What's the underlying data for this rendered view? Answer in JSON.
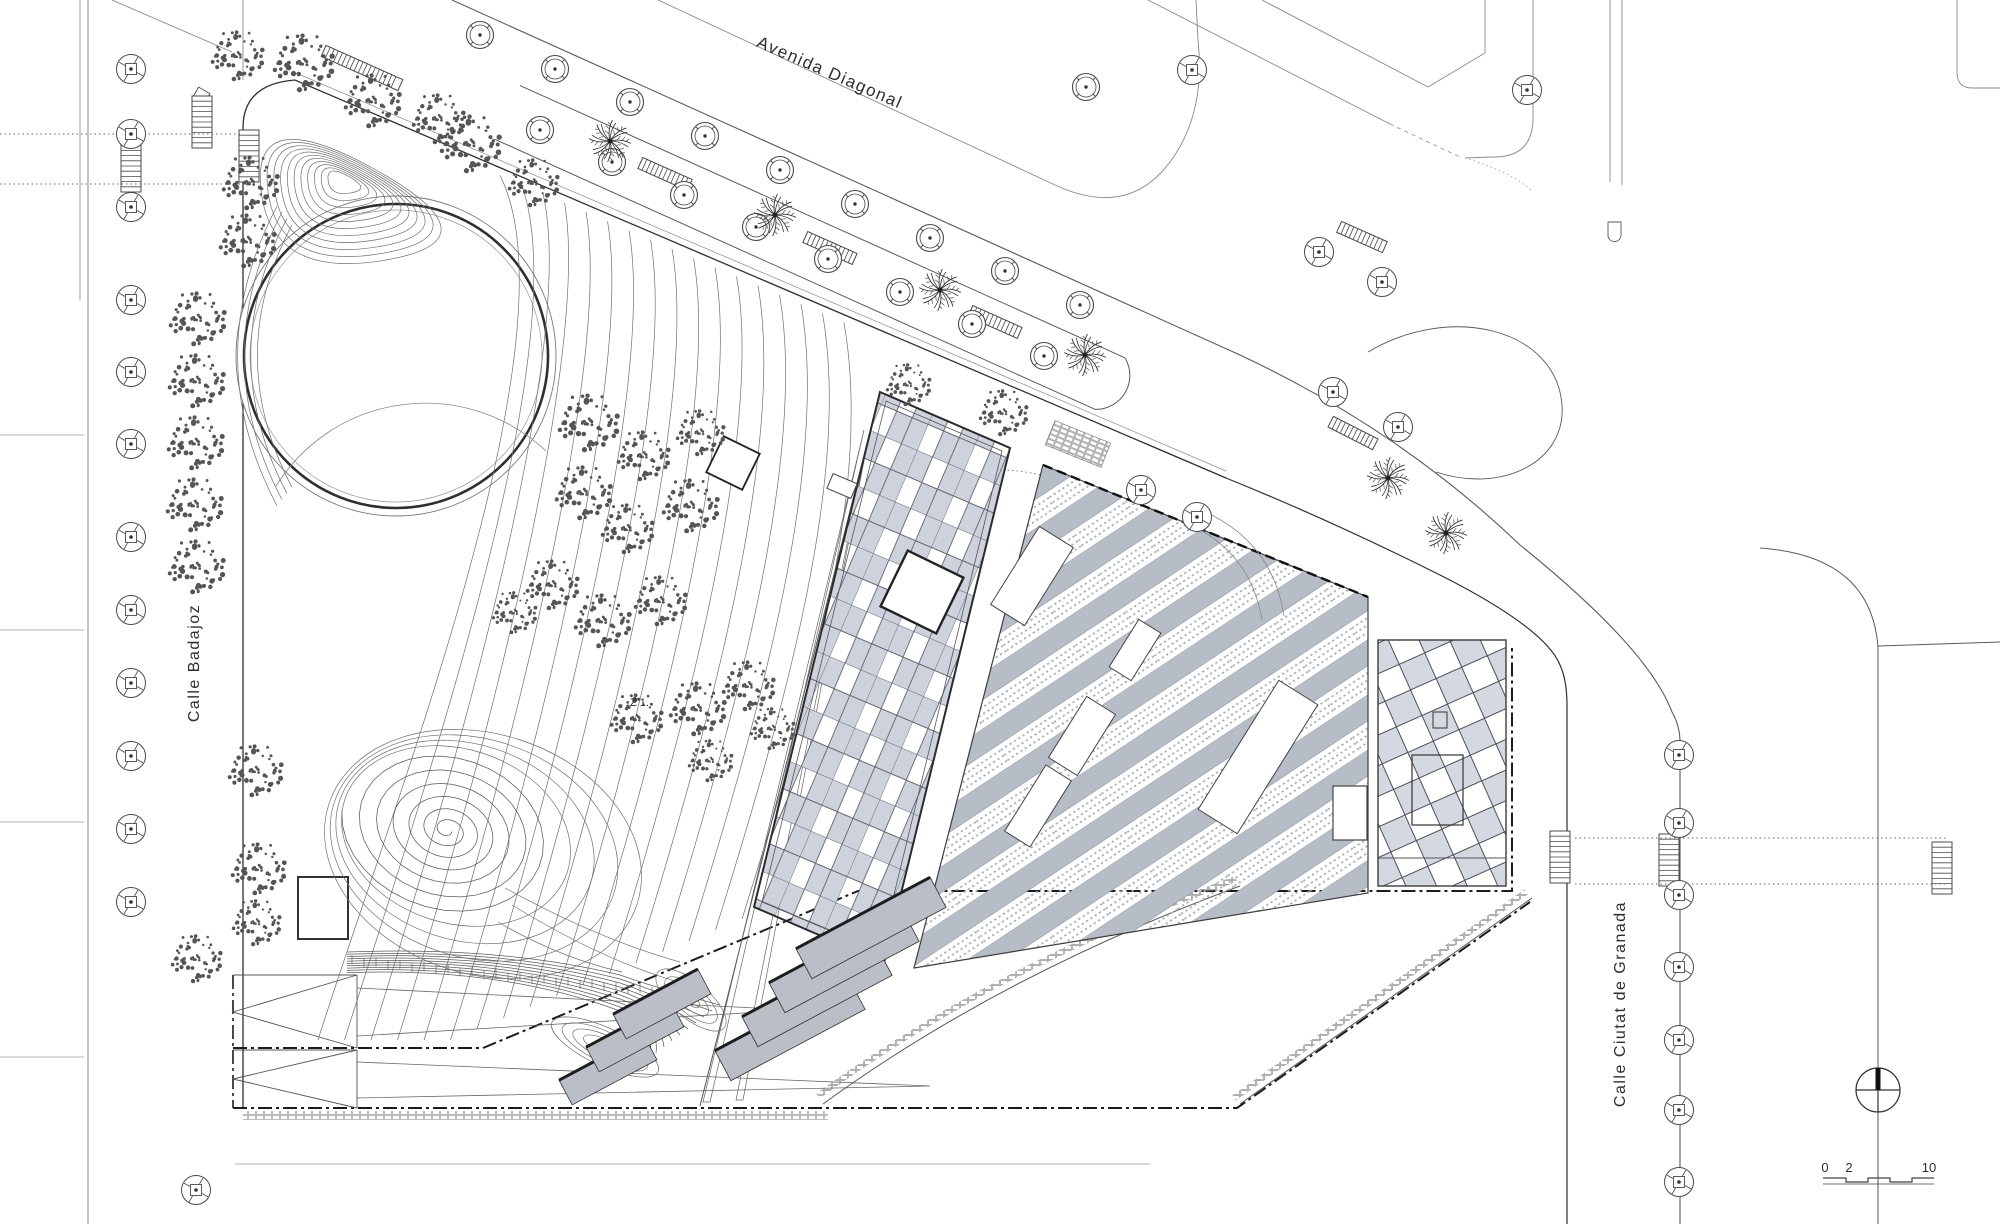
{
  "drawing": {
    "type": "architectural-site-plan",
    "description": "Site plan of a park and building complex bounded by Avenida Diagonal, Calle Badajoz and Calle Ciutat de Granada"
  },
  "labels": {
    "avenue": {
      "text": "Avenida Diagonal"
    },
    "street_left": {
      "text": "Calle Badajoz"
    },
    "street_right": {
      "text": "Calle Ciutat de Granada"
    },
    "zone": {
      "text": "Z 1."
    }
  },
  "scale_bar": {
    "labels": [
      "0",
      "2",
      "10"
    ]
  },
  "colors": {
    "paper": "#ffffff",
    "line_dark": "#2f2f2f",
    "line_mid": "#5a5a5a",
    "line_light": "#8a8a8a",
    "contour": "#6f6f6f",
    "glass_cell": "#cdd2dd",
    "stripe_gray": "#b7bdc7",
    "diamond_fill": "#d4d9e1",
    "stair_gray": "#b9bec7",
    "stipple": "#555555"
  },
  "vegetation": {
    "avenue_trees_row_a": [
      [
        480,
        35
      ],
      [
        555,
        69
      ],
      [
        630,
        102
      ],
      [
        705,
        136
      ],
      [
        780,
        170
      ],
      [
        855,
        204
      ],
      [
        930,
        238
      ],
      [
        1005,
        271
      ],
      [
        1080,
        305
      ]
    ],
    "avenue_trees_row_b": [
      [
        540,
        130
      ],
      [
        612,
        162
      ],
      [
        684,
        195
      ],
      [
        756,
        227
      ],
      [
        828,
        259
      ],
      [
        900,
        292
      ],
      [
        972,
        324
      ],
      [
        1044,
        356
      ]
    ],
    "extra_plaza_trees": [
      [
        1086,
        87
      ]
    ],
    "street_trees_left_x": 131,
    "street_trees_left_y": [
      69,
      134,
      207,
      300,
      372,
      444,
      537,
      610,
      683,
      756,
      829,
      902
    ],
    "street_trees_right_x": 1679,
    "street_trees_right_y": [
      755,
      823,
      895,
      967,
      1040,
      1110,
      1182
    ],
    "corner_grate_trees": [
      [
        1141,
        490
      ],
      [
        1197,
        517
      ],
      [
        1333,
        392
      ],
      [
        1398,
        427
      ],
      [
        1527,
        90
      ],
      [
        1192,
        70
      ],
      [
        1319,
        252
      ],
      [
        1382,
        282
      ],
      [
        196,
        1190
      ]
    ],
    "palms": [
      [
        610,
        141
      ],
      [
        775,
        215
      ],
      [
        940,
        290
      ],
      [
        1085,
        355
      ],
      [
        1388,
        478
      ],
      [
        1446,
        533
      ]
    ],
    "stippled_trees": [
      [
        237,
        55,
        26
      ],
      [
        303,
        62,
        30
      ],
      [
        372,
        100,
        28
      ],
      [
        438,
        118,
        26
      ],
      [
        470,
        143,
        30
      ],
      [
        533,
        182,
        25
      ],
      [
        250,
        182,
        28
      ],
      [
        247,
        240,
        28
      ],
      [
        197,
        318,
        28
      ],
      [
        196,
        380,
        28
      ],
      [
        195,
        442,
        28
      ],
      [
        194,
        504,
        28
      ],
      [
        196,
        566,
        28
      ],
      [
        588,
        422,
        30
      ],
      [
        643,
        455,
        26
      ],
      [
        700,
        432,
        24
      ],
      [
        583,
        492,
        28
      ],
      [
        627,
        528,
        26
      ],
      [
        690,
        505,
        28
      ],
      [
        552,
        584,
        26
      ],
      [
        602,
        620,
        28
      ],
      [
        660,
        600,
        26
      ],
      [
        514,
        612,
        22
      ],
      [
        636,
        718,
        26
      ],
      [
        697,
        708,
        28
      ],
      [
        748,
        685,
        26
      ],
      [
        710,
        760,
        22
      ],
      [
        772,
        728,
        22
      ],
      [
        255,
        770,
        27
      ],
      [
        258,
        868,
        27
      ],
      [
        256,
        922,
        24
      ],
      [
        196,
        958,
        25
      ],
      [
        908,
        384,
        22
      ],
      [
        1003,
        412,
        24
      ]
    ]
  },
  "furniture": {
    "benches": [
      {
        "x": 362,
        "y": 68,
        "rot": 24,
        "len": 84
      },
      {
        "x": 665,
        "y": 174,
        "rot": 24,
        "len": 54
      },
      {
        "x": 830,
        "y": 248,
        "rot": 24,
        "len": 54
      },
      {
        "x": 995,
        "y": 322,
        "rot": 24,
        "len": 54
      },
      {
        "x": 1362,
        "y": 237,
        "rot": 24,
        "len": 50
      },
      {
        "x": 1353,
        "y": 433,
        "rot": 27,
        "len": 50
      }
    ],
    "crossings": [
      [
        131,
        166
      ],
      [
        249,
        156
      ],
      [
        202,
        122
      ],
      [
        1560,
        857
      ],
      [
        1669,
        860
      ],
      [
        1942,
        868
      ]
    ],
    "dotted_guides": [
      [
        0,
        134,
        243,
        134
      ],
      [
        0,
        184,
        243,
        184
      ],
      [
        1575,
        838,
        1948,
        838
      ],
      [
        1575,
        884,
        1948,
        884
      ]
    ]
  },
  "north_arrow": {
    "x": 1878,
    "y": 1090,
    "r": 22
  },
  "features": {
    "pond_circle": {
      "cx": 396,
      "cy": 356,
      "r_outer": 160,
      "r_main": 152,
      "r_inner": 146
    },
    "glass_building": [
      [
        880,
        392
      ],
      [
        1010,
        448
      ],
      [
        884,
        963
      ],
      [
        754,
        907
      ]
    ],
    "striped_hall": [
      [
        1043,
        465
      ],
      [
        1368,
        597
      ],
      [
        1368,
        893
      ],
      [
        914,
        968
      ]
    ],
    "diamond_wing": {
      "x": 1378,
      "y": 640,
      "w": 128,
      "h": 246
    }
  }
}
